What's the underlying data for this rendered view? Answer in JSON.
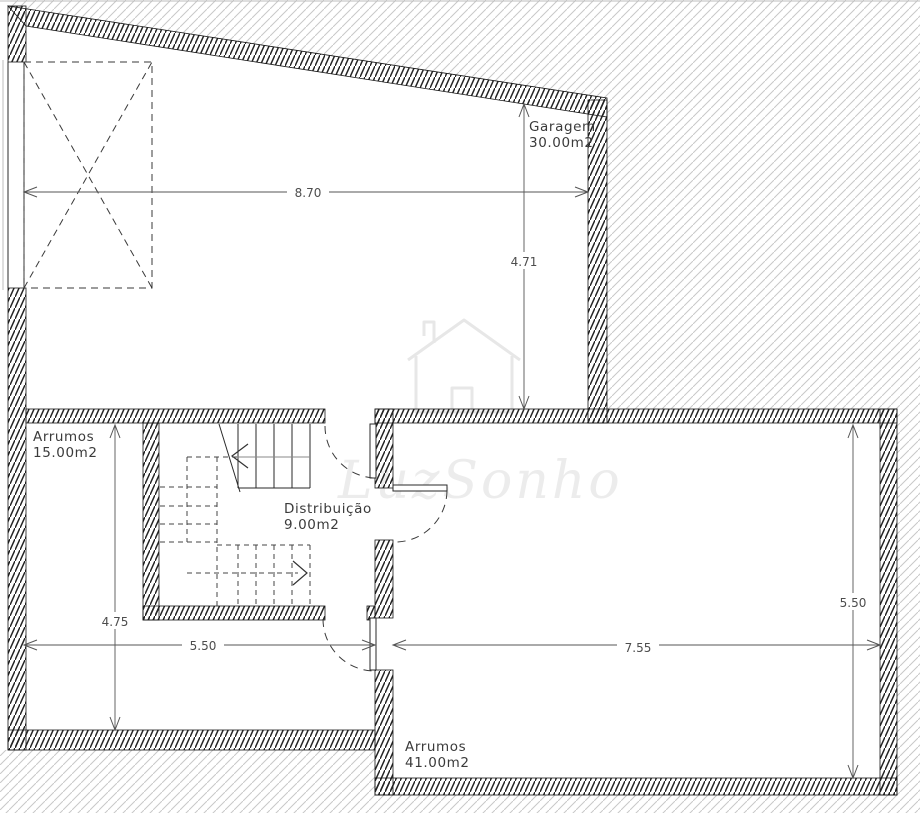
{
  "drawing": {
    "type": "floor-plan",
    "rooms": [
      {
        "name": "Garagem",
        "area": "30.00m2"
      },
      {
        "name": "Arrumos",
        "area": "15.00m2"
      },
      {
        "name": "Distribuição",
        "area": "9.00m2"
      },
      {
        "name": "Arrumos",
        "area": "41.00m2"
      }
    ],
    "dimensions": {
      "garagem_width": "8.70",
      "garagem_depth": "4.71",
      "arrumos15_height": "4.75",
      "arrumos15_width": "5.50",
      "arrumos41_width": "7.55",
      "arrumos41_height": "5.50"
    },
    "watermark": {
      "text": "LuzSonho",
      "icon": "house-outline-icon"
    },
    "colors": {
      "wall_hatch": "#222222",
      "exterior_hatch": "#c8c8c8",
      "dimension_line": "#555555",
      "label_text": "#3b3b3b",
      "watermark": "#ececec",
      "background": "#ffffff"
    }
  }
}
